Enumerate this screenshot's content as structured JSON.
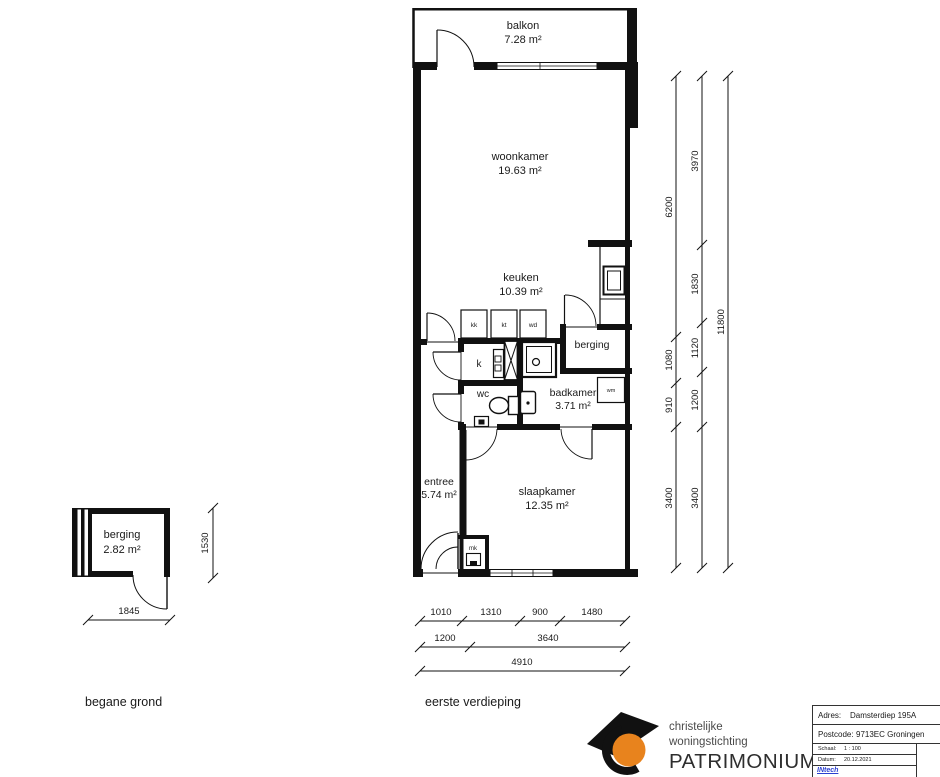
{
  "plans": {
    "ground_floor": {
      "caption": "begane grond",
      "room": {
        "name": "berging",
        "area": "2.82 m²"
      },
      "dim_width": "1845",
      "dim_height": "1530"
    },
    "first_floor": {
      "caption": "eerste verdieping",
      "balkon": {
        "name": "balkon",
        "area": "7.28 m²"
      },
      "woonkamer": {
        "name": "woonkamer",
        "area": "19.63 m²"
      },
      "keuken": {
        "name": "keuken",
        "area": "10.39 m²"
      },
      "berging": {
        "name": "berging"
      },
      "badkamer": {
        "name": "badkamer",
        "area": "3.71 m²"
      },
      "wc": {
        "name": "wc"
      },
      "kast": {
        "name": "k"
      },
      "entree": {
        "name": "entree",
        "area": "5.74 m²"
      },
      "slaapkamer": {
        "name": "slaapkamer",
        "area": "12.35 m²"
      },
      "appliances": {
        "kk": "kk",
        "kt": "kt",
        "wd": "wd",
        "wm": "wm",
        "mk": "mk"
      }
    }
  },
  "dimensions": {
    "right_inner": [
      "6200",
      "1080",
      "910",
      "3400"
    ],
    "right_middle": [
      "3970",
      "1830",
      "1120",
      "1200",
      "3400"
    ],
    "right_outer": [
      "11800"
    ],
    "bottom_row1": [
      "1010",
      "1310",
      "900",
      "1480"
    ],
    "bottom_row2": [
      "1200",
      "3640"
    ],
    "bottom_row3": [
      "4910"
    ]
  },
  "title_block": {
    "org_line1": "christelijke",
    "org_line2": "woningstichting",
    "org_name": "PATRIMONIUM",
    "fields": [
      {
        "label": "Adres:",
        "value": "Damsterdiep 195A"
      },
      {
        "label": "Postcode:",
        "value": "9713EC Groningen"
      },
      {
        "label": "Schaal:",
        "value": "1 : 100"
      },
      {
        "label": "Datum:",
        "value": "20.12.2021"
      }
    ],
    "drafter": "INtech",
    "disclaimer": "Alle maten op deze tekening dienen in het werk gecontroleerd te worden"
  },
  "colors": {
    "logo_orange": "#E8831D",
    "drafter_blue": "#2b3fd0"
  }
}
